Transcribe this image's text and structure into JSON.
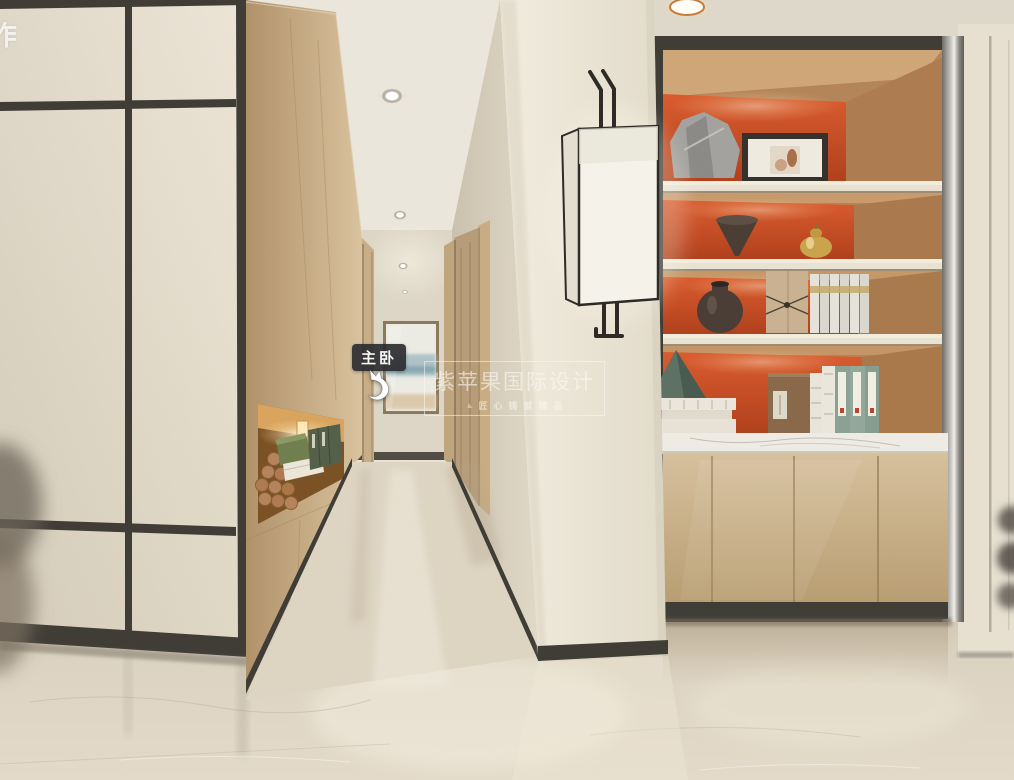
{
  "overlay": {
    "corner_char": "作",
    "hotspot_label": "主卧",
    "watermark_title": "紫苹果国际设计",
    "watermark_subtitle": "匠心铸就精品"
  },
  "colors": {
    "frame_dark": "#403d37",
    "panel_cream": "#e8e1d2",
    "wall_cream": "#e9e3d5",
    "wall_shade": "#ded6c5",
    "wood_light": "#cfb893",
    "wood_dark": "#a98b62",
    "shelf_orange": "#cf5227",
    "shelf_wood": "#c2946a",
    "cabinet_wood": "#cbb28b",
    "marble_white": "#edebe4",
    "floor_beige": "#d9cfbd",
    "lamp_shade": "#f5f2ea",
    "lamp_frame": "#2e2b27",
    "tag_bg": "#2a2a2e",
    "text_white": "#ffffff",
    "wm_text": "#faf8f2",
    "glow_warm": "#e8b872"
  }
}
